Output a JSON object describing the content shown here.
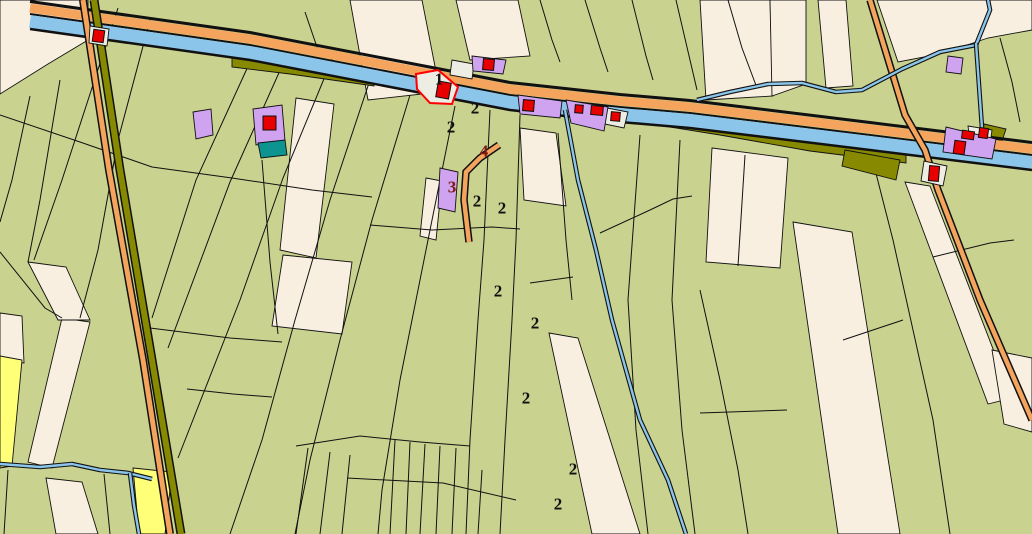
{
  "map": {
    "width": 1032,
    "height": 534,
    "colors": {
      "green": "#C9D28F",
      "cream": "#F9EFE1",
      "grey": "#EDEDE4",
      "purple": "#CFA3EF",
      "teal": "#0D9490",
      "red": "#E80000",
      "blue": "#8CC5EA",
      "orange": "#F4A45C",
      "olive": "#878A00",
      "yellow": "#FFFF78",
      "ink": "#111111",
      "maroon": "#801812",
      "red_outline": "#FF0000"
    },
    "base_parcels": [
      {
        "name": "parcel-cream",
        "fill": "cream",
        "pts": "0,0 88,0 88,40 48,64 0,94"
      },
      {
        "name": "parcel-cream",
        "fill": "cream",
        "pts": "350,0 422,0 440,92 368,100"
      },
      {
        "name": "parcel-cream",
        "fill": "cream",
        "pts": "456,0 518,0 530,56 470,60"
      },
      {
        "name": "parcel-cream",
        "fill": "cream",
        "pts": "700,0 770,0 773,96 706,100"
      },
      {
        "name": "parcel-cream",
        "fill": "cream",
        "pts": "770,0 806,0 806,84 772,96"
      },
      {
        "name": "parcel-cream",
        "fill": "cream",
        "pts": "818,0 846,0 853,86 826,88"
      },
      {
        "name": "parcel-cream",
        "fill": "cream",
        "pts": "877,0 1032,0 1032,30 988,38 940,54 898,62"
      },
      {
        "name": "parcel-cream",
        "fill": "cream",
        "pts": "296,98 334,104 316,258 280,250"
      },
      {
        "name": "parcel-cream",
        "fill": "cream",
        "pts": "283,255 352,262 342,334 272,326"
      },
      {
        "name": "parcel-cream",
        "fill": "cream",
        "pts": "426,178 442,181 436,240 420,236"
      },
      {
        "name": "parcel-cream",
        "fill": "cream",
        "pts": "520,128 556,133 566,206 524,200"
      },
      {
        "name": "parcel-cream",
        "fill": "cream",
        "pts": "549,333 578,338 640,534 592,534"
      },
      {
        "name": "parcel-cream",
        "fill": "cream",
        "pts": "793,222 852,232 900,534 838,534"
      },
      {
        "name": "parcel-cream",
        "fill": "cream",
        "pts": "712,148 788,158 780,268 706,262"
      },
      {
        "name": "parcel-cream",
        "fill": "cream",
        "pts": "905,182 930,186 1012,398 988,404"
      },
      {
        "name": "parcel-cream",
        "fill": "cream",
        "pts": "992,350 1032,358 1032,432 1004,424"
      },
      {
        "name": "parcel-cream",
        "fill": "cream",
        "pts": "0,313 22,316 24,363 0,360"
      },
      {
        "name": "parcel-cream",
        "fill": "cream",
        "pts": "62,318 90,322 52,468 28,462"
      },
      {
        "name": "parcel-cream",
        "fill": "cream",
        "pts": "46,478 82,482 98,534 56,534"
      },
      {
        "name": "parcel-cream",
        "fill": "cream",
        "pts": "28,262 66,267 90,320 58,320"
      },
      {
        "name": "parcel-yellow",
        "fill": "yellow",
        "pts": "0,356 22,360 12,466 0,468"
      },
      {
        "name": "parcel-yellow",
        "fill": "yellow",
        "pts": "133,468 172,472 165,534 139,534"
      }
    ],
    "boundaries": [
      {
        "pts": "0,115 80,142 152,167 232,178 312,190 372,197"
      },
      {
        "pts": "118,8 62,180 34,260"
      },
      {
        "pts": "30,96 12,180 0,222"
      },
      {
        "pts": "60,80 40,200 28,262"
      },
      {
        "pts": "150,20 118,140 98,250 80,318"
      },
      {
        "pts": "104,474 110,534"
      },
      {
        "pts": "8,470 4,534"
      },
      {
        "pts": "0,252 45,308 62,318"
      },
      {
        "pts": "250,62 196,180 152,318"
      },
      {
        "pts": "282,66 230,182 168,348"
      },
      {
        "pts": "333,57 283,178 240,300 178,458"
      },
      {
        "pts": "370,80 330,200 295,320 262,440 230,534"
      },
      {
        "pts": "410,95 372,220 340,340 310,460 295,534"
      },
      {
        "pts": "455,106 428,240 400,380 382,490 378,534"
      },
      {
        "pts": "490,110 484,240 478,320 470,440 466,534"
      },
      {
        "pts": "520,115 516,240 512,320 505,440 500,534"
      },
      {
        "pts": "558,133 566,240 572,300"
      },
      {
        "pts": "640,135 628,300 636,430 648,534"
      },
      {
        "pts": "680,140 672,300 682,430 695,534"
      },
      {
        "pts": "745,155 738,266"
      },
      {
        "pts": "870,150 893,240 913,330 933,420 950,534"
      },
      {
        "pts": "700,290 720,380 738,470 748,534"
      },
      {
        "pts": "728,0 742,48 757,88"
      },
      {
        "pts": "1000,38 1012,82 1020,122"
      },
      {
        "pts": "305,12 318,50"
      },
      {
        "pts": "540,0 552,40 560,62"
      },
      {
        "pts": "585,0 600,48 608,72"
      },
      {
        "pts": "632,0 646,56 653,80"
      },
      {
        "pts": "676,0 690,60 697,90"
      },
      {
        "pts": "370,225 432,230 492,227 520,229"
      },
      {
        "pts": "150,328 230,338 282,342"
      },
      {
        "pts": "600,233 650,210 673,199 692,196"
      },
      {
        "pts": "530,283 573,277"
      },
      {
        "pts": "347,478 443,483 516,500"
      },
      {
        "pts": "700,413 787,410"
      },
      {
        "pts": "843,340 903,320"
      },
      {
        "pts": "933,257 990,243 1014,240"
      },
      {
        "pts": "692,128 770,142 838,151"
      },
      {
        "pts": "187,389 233,394 272,397"
      },
      {
        "pts": "262,160 270,262 278,334"
      },
      {
        "pts": "395,440 390,534"
      },
      {
        "pts": "410,442 406,534"
      },
      {
        "pts": "425,444 420,534"
      },
      {
        "pts": "440,446 436,534"
      },
      {
        "pts": "456,448 452,534"
      },
      {
        "pts": "482,470 478,534"
      },
      {
        "pts": "350,455 342,534"
      },
      {
        "pts": "330,452 320,534"
      },
      {
        "pts": "308,448 296,534"
      },
      {
        "pts": "296,446 360,436 420,442 470,446"
      }
    ],
    "olive_patches": [
      {
        "name": "canal-bank-olive",
        "pts": "232,56 290,63 374,77 374,86 290,74 232,67"
      },
      {
        "name": "canal-bank-olive",
        "pts": "626,108 720,124 810,140 906,152 906,163 810,151 720,135 626,120"
      },
      {
        "name": "canal-bank-olive",
        "pts": "845,150 900,160 896,180 842,166"
      },
      {
        "name": "canal-bank-olive",
        "pts": "984,124 1006,129 1002,141 982,136"
      }
    ],
    "canal": {
      "path": "30,0 250,31 510,81 620,93 690,99 870,121 1032,141",
      "bands": [
        {
          "dy": 1.5,
          "w": 3,
          "color": "ink"
        },
        {
          "dy": 8,
          "w": 9,
          "color": "orange"
        },
        {
          "dy": 14,
          "w": 2,
          "color": "ink"
        },
        {
          "dy": 21.5,
          "w": 13,
          "color": "blue"
        },
        {
          "dy": 29,
          "w": 2.5,
          "color": "ink"
        }
      ]
    },
    "roads": [
      {
        "name": "road-west",
        "pts": "83,0 109,170 143,360 170,534",
        "w": 5,
        "casing": 8,
        "color": "orange"
      },
      {
        "name": "road-west-verge",
        "pts": "94,0 120,170 152,360 181,534",
        "w": 6,
        "casing": 9,
        "color": "olive"
      },
      {
        "name": "road-east",
        "pts": "870,0 905,115 925,150 938,190 980,300 1032,420",
        "w": 4.5,
        "casing": 7.5,
        "color": "orange"
      },
      {
        "name": "road-spur",
        "pts": "499,145 480,158 466,172 464,200 469,242",
        "w": 4.5,
        "casing": 7.5,
        "color": "orange"
      }
    ],
    "streams": [
      {
        "name": "stream",
        "pts": "565,110 578,180 596,250 612,320 640,420 668,480 686,534"
      },
      {
        "name": "stream",
        "pts": "0,464 40,467 72,464 100,470 128,473 152,479"
      },
      {
        "name": "stream",
        "pts": "130,473 134,505 139,534"
      },
      {
        "name": "stream",
        "pts": "697,100 730,92 768,84 802,83 836,92 862,90 902,69 940,52 976,45 990,10 988,0"
      },
      {
        "name": "stream",
        "pts": "976,43 982,128"
      }
    ],
    "feature_parcels": [
      {
        "name": "parcel-built",
        "fill": "grey",
        "pts": "90,26 109,29 107,46 89,43"
      },
      {
        "name": "parcel-built",
        "fill": "grey",
        "pts": "452,60 474,64 472,79 450,75"
      },
      {
        "name": "parcel-built",
        "fill": "grey",
        "pts": "602,107 628,112 624,128 600,123"
      },
      {
        "name": "parcel-built",
        "fill": "grey",
        "pts": "924,161 947,166 943,186 921,181"
      },
      {
        "name": "parcel-built",
        "fill": "grey",
        "pts": "968,126 992,130 990,145 970,141"
      },
      {
        "name": "parcel-purple",
        "fill": "purple",
        "pts": "193,112 211,109 213,135 196,139"
      },
      {
        "name": "parcel-purple",
        "fill": "purple",
        "pts": "253,109 282,105 285,141 256,145"
      },
      {
        "name": "parcel-teal",
        "fill": "teal",
        "pts": "258,143 285,140 287,155 261,158"
      },
      {
        "name": "parcel-purple",
        "fill": "purple",
        "pts": "472,56 506,60 503,74 473,71"
      },
      {
        "name": "parcel-purple",
        "fill": "purple",
        "pts": "518,95 562,101 560,118 520,114"
      },
      {
        "name": "parcel-purple",
        "fill": "purple",
        "pts": "566,100 608,107 604,131 571,123"
      },
      {
        "name": "parcel-purple",
        "fill": "purple",
        "pts": "440,168 458,172 455,212 438,208"
      },
      {
        "name": "parcel-purple",
        "fill": "purple",
        "pts": "946,127 996,139 992,159 943,152"
      },
      {
        "name": "parcel-purple",
        "fill": "purple",
        "pts": "948,56 963,58 961,74 946,72"
      },
      {
        "name": "parcel-selected",
        "fill": "grey",
        "stroke": "red_outline",
        "sw": 2,
        "pts": "416,74 438,70 458,87 452,104 430,103 417,89"
      }
    ],
    "buildings": [
      {
        "x": 93,
        "y": 30,
        "w": 11,
        "h": 12,
        "r": 8
      },
      {
        "x": 263,
        "y": 116,
        "w": 13,
        "h": 14,
        "r": 0
      },
      {
        "x": 437,
        "y": 82,
        "w": 13,
        "h": 16,
        "r": 10
      },
      {
        "x": 483,
        "y": 59,
        "w": 11,
        "h": 11,
        "r": 5
      },
      {
        "x": 523,
        "y": 100,
        "w": 11,
        "h": 11,
        "r": 5
      },
      {
        "x": 575,
        "y": 105,
        "w": 8,
        "h": 8,
        "r": 5
      },
      {
        "x": 591,
        "y": 106,
        "w": 12,
        "h": 9,
        "r": 5
      },
      {
        "x": 611,
        "y": 112,
        "w": 9,
        "h": 9,
        "r": 5
      },
      {
        "x": 929,
        "y": 166,
        "w": 10,
        "h": 15,
        "r": 5
      },
      {
        "x": 954,
        "y": 141,
        "w": 11,
        "h": 13,
        "r": 8
      },
      {
        "x": 962,
        "y": 131,
        "w": 12,
        "h": 8,
        "r": 8
      },
      {
        "x": 979,
        "y": 128,
        "w": 9,
        "h": 10,
        "r": 8
      }
    ],
    "labels": [
      {
        "text": "1",
        "x": 439,
        "y": 79,
        "color": "ink"
      },
      {
        "text": "2",
        "x": 475,
        "y": 108,
        "color": "ink"
      },
      {
        "text": "2",
        "x": 451,
        "y": 127,
        "color": "ink"
      },
      {
        "text": "2",
        "x": 477,
        "y": 201,
        "color": "ink"
      },
      {
        "text": "2",
        "x": 502,
        "y": 208,
        "color": "ink"
      },
      {
        "text": "2",
        "x": 498,
        "y": 291,
        "color": "ink"
      },
      {
        "text": "2",
        "x": 535,
        "y": 323,
        "color": "ink"
      },
      {
        "text": "2",
        "x": 526,
        "y": 398,
        "color": "ink"
      },
      {
        "text": "2",
        "x": 573,
        "y": 469,
        "color": "ink"
      },
      {
        "text": "2",
        "x": 558,
        "y": 504,
        "color": "ink"
      },
      {
        "text": "3",
        "x": 452,
        "y": 187,
        "color": "maroon"
      },
      {
        "text": "4",
        "x": 484,
        "y": 151,
        "color": "maroon"
      }
    ]
  }
}
